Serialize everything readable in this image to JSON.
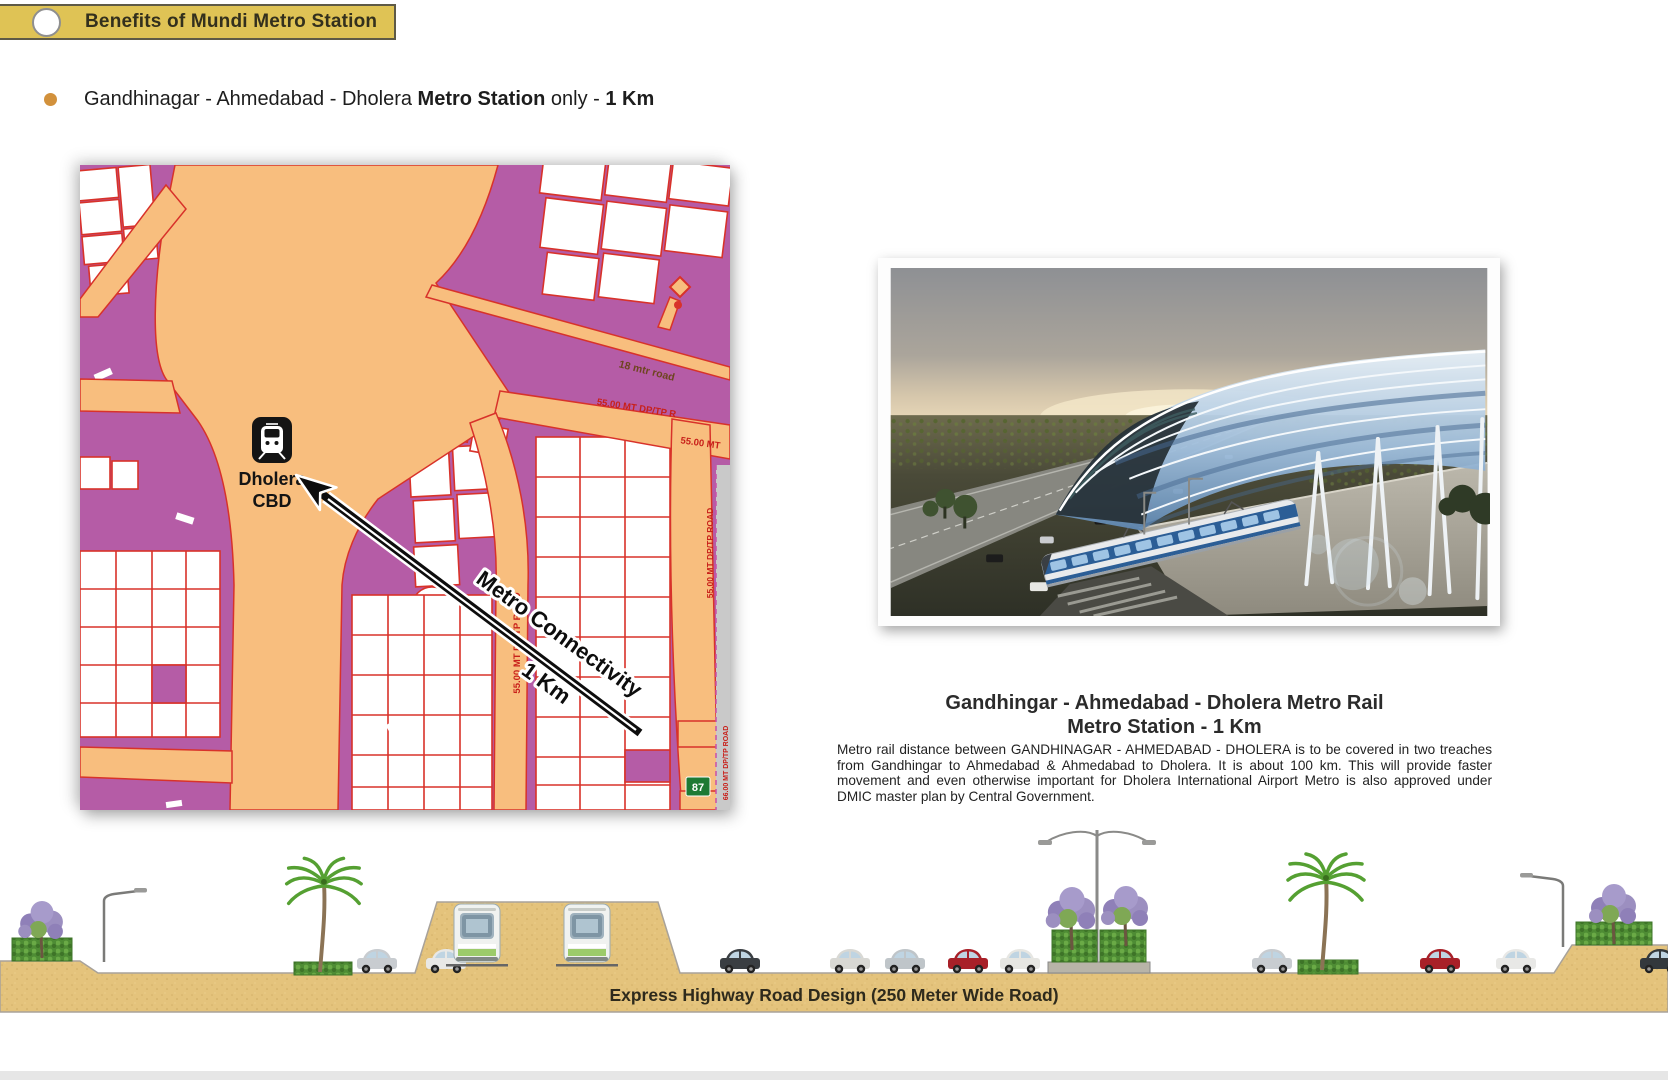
{
  "header": {
    "title": "Benefits of Mundi Metro Station"
  },
  "bullet": {
    "pre": "Gandhinagar - Ahmedabad - Dholera ",
    "bold1": "Metro Station",
    "mid": " only - ",
    "bold2": "1 Km"
  },
  "map": {
    "station": {
      "line1": "Dholera",
      "line2": "CBD"
    },
    "arrow": {
      "line1": "Metro  Connectivity",
      "line2": "1  Km"
    },
    "labels": {
      "road18": "18 mtr road",
      "road55_diag": "55.00 MT DP/TP R",
      "road55_short": "55.00 MT",
      "road55_vert": "55.00 MT DP/TP ROAD",
      "road55_vert2": "55.00 MT DP/TP ROAD",
      "road66_vert": "66.00 MT DP/TP ROAD",
      "highway_shield": "87"
    }
  },
  "photo": {
    "heading_line1": "Gandhingar - Ahmedabad - Dholera Metro Rail",
    "heading_line2": "Metro Station - 1 Km",
    "body": "Metro rail distance between GANDHINAGAR - AHMEDABAD - DHOLERA is to be covered in two treaches from Gandhingar to Ahmedabad & Ahmedabad to Dholera. It is about 100 km. This will provide faster movement and even otherwise important for Dholera International Airport Metro is also approved under DMIC master plan by Central Government."
  },
  "cross_section": {
    "caption": "Express Highway Road Design (250 Meter Wide Road)"
  },
  "colors": {
    "banner_yellow": "#DFC355",
    "bullet_dot": "#D2913C",
    "map_purple": "#B55CA6",
    "map_orange": "#F8BE7E",
    "map_red": "#D8322A",
    "ground_tan": "#E4C37C",
    "shield_green": "#1E7A34"
  }
}
